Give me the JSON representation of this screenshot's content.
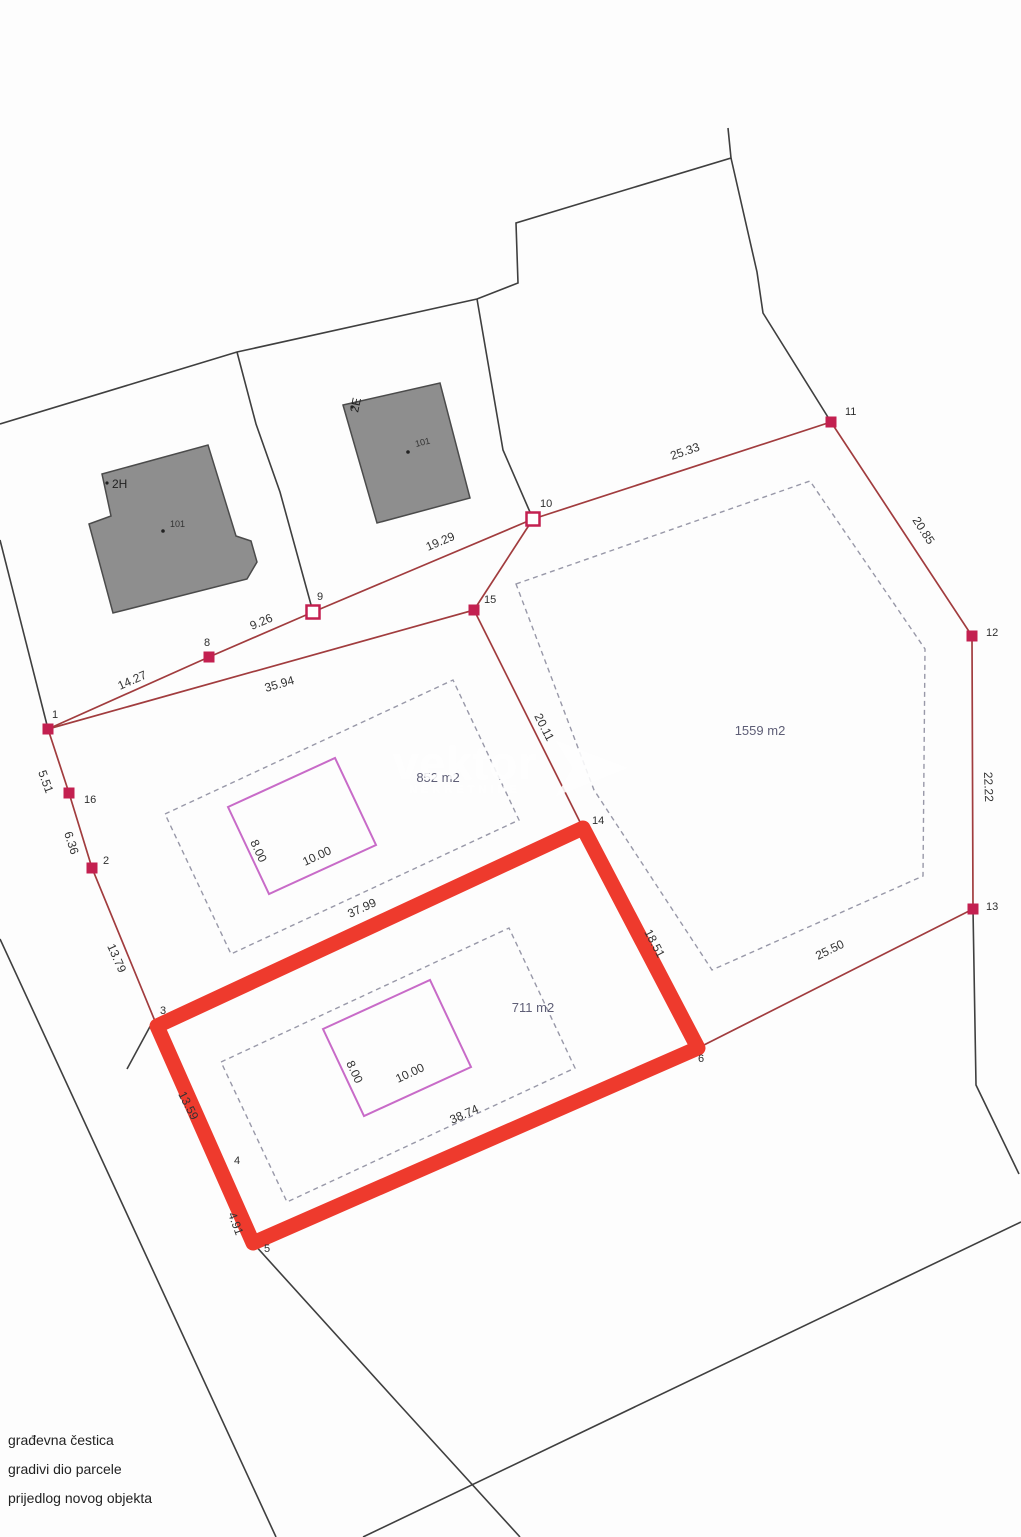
{
  "plan": {
    "edges": {
      "e1_8": "14.27",
      "e8_9": "9.26",
      "e9_10": "19.29",
      "e10_11": "25.33",
      "e11_12": "20.85",
      "e12_13": "22.22",
      "e13_6": "25.50",
      "e6_14": "18.51",
      "e14_15": "20.11",
      "e15_1": "35.94",
      "e1_16": "5.51",
      "e16_2": "6.36",
      "e2_3": "13.79",
      "e3_4": "13.59",
      "e4_5": "4.91",
      "e5_6": "38.74",
      "e3_14": "37.99"
    },
    "points": {
      "p1": "1",
      "p2": "2",
      "p3": "3",
      "p4": "4",
      "p5": "5",
      "p6": "6",
      "p8": "8",
      "p9": "9",
      "p10": "10",
      "p11": "11",
      "p12": "12",
      "p13": "13",
      "p14": "14",
      "p15": "15",
      "p16": "16"
    },
    "areas": {
      "right_parcel": "1559 m2",
      "lower_parcel": "711 m2",
      "middle_parcel": "852 m2"
    },
    "buildings": [
      {
        "code": "2H",
        "number": "101"
      },
      {
        "code": "2E",
        "number": "101"
      }
    ],
    "new_objects": [
      {
        "width": "8.00",
        "length": "10.00"
      },
      {
        "width": "8.00",
        "length": "10.00"
      }
    ],
    "watermark": {
      "brand": "vektor",
      "subtitle": "NEKRETNINE"
    },
    "legend": [
      {
        "label": "građevna čestica"
      },
      {
        "label": "gradivi dio parcele"
      },
      {
        "label": "prijedlog novog objekta"
      }
    ],
    "colors": {
      "highlight_red": "#ee3a2d",
      "boundary_red": "#a13c3e",
      "marker_red": "#c32050",
      "proposed_object_magenta": "#c86bc8",
      "building_gray": "#8e8e8e",
      "buildable_dash_gray": "#9898a8",
      "cadastre_black": "#3f3f3f"
    }
  }
}
